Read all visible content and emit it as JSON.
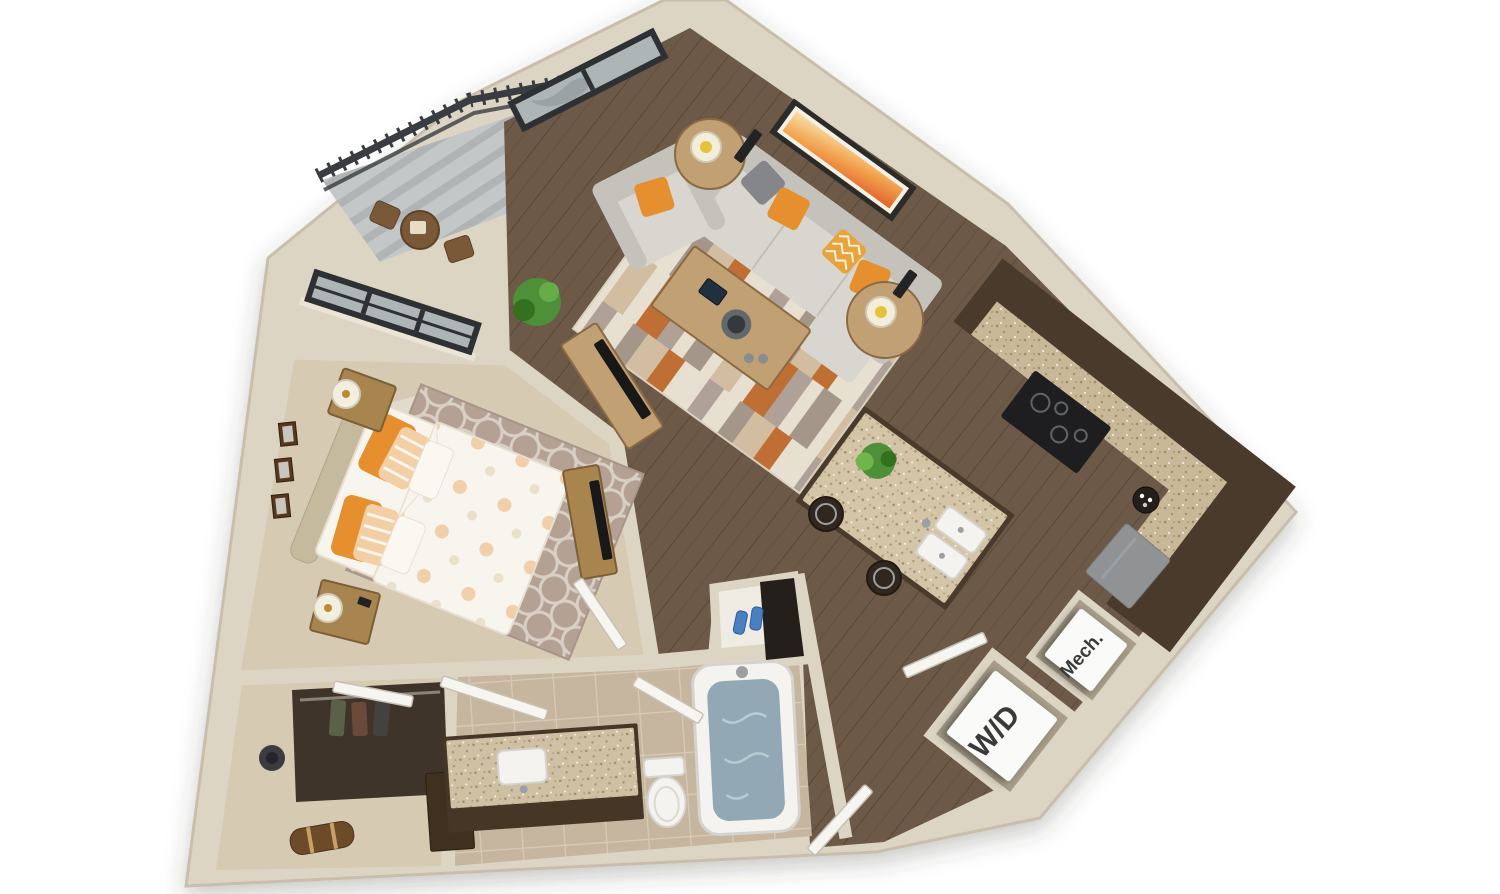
{
  "labels": {
    "washer_dryer": "W/D",
    "mechanical": "Mech."
  },
  "colors": {
    "bg": "#ffffff",
    "wall": "#ddd5c4",
    "wall_edge": "#c8beab",
    "niche": "#a89e8a",
    "wood": "#6c5947",
    "wood_line": "#594837",
    "carpet": "#d6cab3",
    "tile": "#c6b69f",
    "grout": "#d8cbb6",
    "cabinet": "#4a3a2b",
    "granite": "#c9b897",
    "speck": "#8a775b",
    "island_top": "#d4c5a6",
    "stove": "#1e1e20",
    "fridge": "#909294",
    "sofa": "#d9d6d0",
    "sofa_dark": "#c5c2bb",
    "pillow_orange": "#e58f2f",
    "pillow_gray": "#84868a",
    "pillow_chevron": "#e8a43a",
    "rug_base": "#e7e0d1",
    "rug_tan": "#d3bda0",
    "rug_orange": "#bf6f33",
    "rug_mauve": "#b0a198",
    "rug_gray": "#a49689",
    "wood_furn": "#c1a173",
    "wood_dark": "#8a6a43",
    "nightstand": "#a8854f",
    "nightstand_edge": "#7c5f36",
    "art_frame": "#2d2b28",
    "plant": "#4d9038",
    "plant_dark": "#33701f",
    "pot": "#3a352f",
    "bed_white": "#f8f5ee",
    "bed_shade": "#e6dfd1",
    "headboard": "#c6ba9e",
    "bedrug": "#b5a094",
    "bedrug_line": "#d9cfc5",
    "water": "#92a9b5",
    "fixture": "#f4f3f0",
    "fixture_edge": "#d5d3cd",
    "door": "#f7f5f0",
    "door_edge": "#c6c1b6",
    "rail": "#393c40",
    "deck": "#c4c7c8",
    "deck_stripe": "#b1b4b5",
    "patio": "#7a5938",
    "win_frame": "#2e3134",
    "glass": "#aeb5b7",
    "glass_dark": "#90989c",
    "label_ink": "#3a3a3a",
    "cube": "#fafaf9",
    "shoe": "#4a7fc1",
    "closet_dark": "#3f342a",
    "duffel": "#6d4a28",
    "strap": "#c9a066",
    "stool": "#32271e",
    "metal": "#9aa0a4",
    "tv": "#181818"
  }
}
